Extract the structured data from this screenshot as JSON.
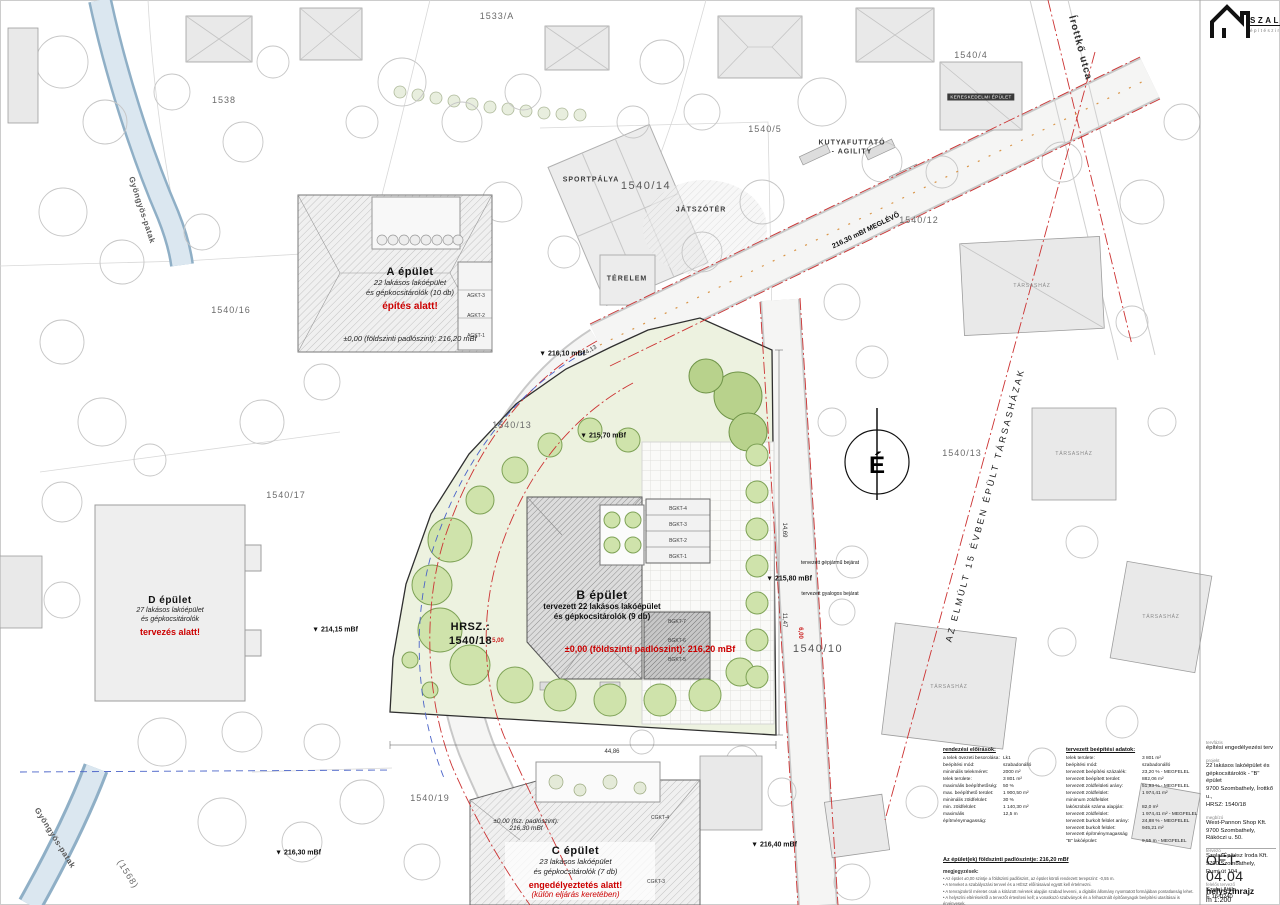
{
  "logo": {
    "name": "SZALAI",
    "subtitle": "építésziroda"
  },
  "site": {
    "hrsz_line1": "HRSZ.:",
    "hrsz_line2": "1540/18"
  },
  "buildings": {
    "a": {
      "title": "A épület",
      "line1": "22 lakásos lakóépület",
      "line2": "és gépkocsitárolók (10 db)",
      "status": "építés alatt!",
      "level": "±0,00 (földszinti padlószint): 216,20 mBf"
    },
    "b": {
      "title": "B épület",
      "line1": "tervezett 22 lakásos lakóépület",
      "line2": "és gépkocsitárolók (9 db)",
      "level": "±0,00 (földszinti padlószint): 216,20 mBf"
    },
    "c": {
      "title": "C épület",
      "line1": "23 lakásos lakóépület",
      "line2": "és gépkocsitárolók (7 db)",
      "status1": "engedélyeztetés alatt!",
      "status2": "(külön eljárás keretében)",
      "level1": "±0,00 (fsz. padlószint):",
      "level2": "216,30 mBf"
    },
    "d": {
      "title": "D épület",
      "line1": "27 lakásos lakóépület",
      "line2": "és gépkocsitárolók",
      "status": "tervezés alatt!"
    }
  },
  "titleblock": {
    "phase_label": "tervfázis",
    "phase": "építési engedélyezési terv",
    "project_label": "projekt",
    "project_lines": [
      "22 lakásos lakóépület és",
      "gépkocsitárolók - \"B\" épület",
      "9700 Szombathely, Írottkő u.,",
      "HRSZ: 1540/18"
    ],
    "client_label": "megbízó",
    "client_lines": [
      "West-Pannon Shop Kft.",
      "9700 Szombathely,",
      "Rákóczi u. 50."
    ],
    "designer_label": "tervező",
    "designer_lines": [
      "Szalai Építész Iroda Kft.",
      "9700 Szombathely,",
      "Rumi út 104."
    ],
    "lead_label": "felelős tervező",
    "lead_lines": [
      "Szalai Attila",
      "É 16-0240"
    ],
    "sheet_no": "OÉT-04.04",
    "sheet_name": "helyszínrajz",
    "scale": "m 1:200",
    "date_label": "dátum",
    "date": "2023. november",
    "jobno_label": "munkaszám",
    "jobno": "2024/09-B-03"
  },
  "reg_table": {
    "title": "rendezési előírások:",
    "rows": [
      [
        "a telek övezeti besorolása:",
        "Lk1"
      ],
      [
        "beépítési mód:",
        "szabadonálló"
      ],
      [
        "minimális telekméret:",
        "2000 m²"
      ],
      [
        "telek területe:",
        "3 801 m²"
      ],
      [
        "maximális beépíthetőség:",
        "50 %"
      ],
      [
        "max. beépíthető terület:",
        "1 900,50 m²"
      ],
      [
        "minimális zöldfelület:",
        "30 %"
      ],
      [
        "min. zöldfelület:",
        "1 140,30 m²"
      ],
      [
        "maximális építménymagasság:",
        "12,5 m"
      ]
    ]
  },
  "plan_table": {
    "title": "tervezett beépítési adatok:",
    "rows": [
      [
        "telek területe:",
        "3 801 m²"
      ],
      [
        "beépítési mód:",
        "szabadonálló"
      ],
      [
        "tervezett beépítési százalék:",
        "23,20 % - MEGFELEL"
      ],
      [
        "tervezett beépített terület:",
        "882,06 m²"
      ],
      [
        "tervezett zöldfelületi arány:",
        "51,93 % - MEGFELEL"
      ],
      [
        "tervezett zöldfelület:",
        "1 974,41 m²"
      ],
      [
        "minimum zöldfelület",
        ""
      ],
      [
        "lakószobák száma alapján:",
        "82,0 m²"
      ],
      [
        "tervezett zöldfelület:",
        "1 974,41 m² - MEGFELEL"
      ],
      [
        "tervezett burkolt felület arány:",
        "24,88 % - MEGFELEL"
      ],
      [
        "tervezett burkolt felület:",
        "945,21 m²"
      ],
      [
        "tervezett építménymagasság",
        ""
      ],
      [
        "\"B\" lakóépület:",
        "9,55 m - MEGFELEL"
      ]
    ]
  },
  "floor_note": "Az épület(ek) földszinti padlószintje: 216,20 mBf",
  "remarks": {
    "title": "megjegyzések:",
    "items": [
      "Az épület ±0,00 szintje a földszinti padlószint, az épület körüli rendezett terepszint: -0,55 m.",
      "A terveket a szabályozási tervvel és a HÉSZ előírásaival együtt kell értelmezni.",
      "A tervrajzokról méretet csak a kótázott méretek alapján szabad levenni, a digitális állomány nyomtatott formájában pontatlanság lehet.",
      "A helyszíni eltérésekről a tervezőt értesíteni kell; a vonatkozó szabványok és a felhasznált építőanyagok beépítési utasításai is érvényesek."
    ]
  },
  "map_labels": [
    {
      "t": "1533/A",
      "x": 497,
      "y": 16,
      "c": "parcel",
      "n": "parcel-label-1533a"
    },
    {
      "t": "1538",
      "x": 224,
      "y": 100,
      "c": "parcel",
      "n": "parcel-label-1538"
    },
    {
      "t": "1540/4",
      "x": 971,
      "y": 55,
      "c": "parcel",
      "n": "parcel-label-1540-4"
    },
    {
      "t": "1540/5",
      "x": 765,
      "y": 129,
      "c": "parcel",
      "n": "parcel-label-1540-5"
    },
    {
      "t": "1540/12",
      "x": 919,
      "y": 220,
      "c": "parcel",
      "n": "parcel-label-1540-12"
    },
    {
      "t": "1540/14",
      "x": 646,
      "y": 186,
      "c": "parcel-lg",
      "n": "parcel-label-1540-14"
    },
    {
      "t": "1540/16",
      "x": 231,
      "y": 310,
      "c": "parcel",
      "n": "parcel-label-1540-16"
    },
    {
      "t": "1540/13",
      "x": 512,
      "y": 425,
      "c": "parcel",
      "n": "parcel-label-1540-13w"
    },
    {
      "t": "1540/17",
      "x": 286,
      "y": 495,
      "c": "parcel",
      "n": "parcel-label-1540-17"
    },
    {
      "t": "1540/13",
      "x": 962,
      "y": 453,
      "c": "parcel",
      "n": "parcel-label-1540-13e"
    },
    {
      "t": "1540/10",
      "x": 818,
      "y": 649,
      "c": "parcel-lg",
      "n": "parcel-label-1540-10"
    },
    {
      "t": "1540/19",
      "x": 430,
      "y": 798,
      "c": "parcel",
      "n": "parcel-label-1540-19"
    },
    {
      "t": "SPORTPÁLYA",
      "x": 591,
      "y": 180,
      "c": "area",
      "n": "sports-field-label"
    },
    {
      "t": "JÁTSZÓTÉR",
      "x": 701,
      "y": 210,
      "c": "area",
      "n": "playground-label"
    },
    {
      "t": "TÉRELEM",
      "x": 627,
      "y": 279,
      "c": "area",
      "n": "terelem-label"
    },
    {
      "t": "KUTYAFUTTATÓ",
      "x": 852,
      "y": 143,
      "c": "area",
      "n": "dog-run-label"
    },
    {
      "t": "- AGILITY",
      "x": 852,
      "y": 152,
      "c": "area",
      "n": "dog-run-label2"
    },
    {
      "t": "Írottkő utca",
      "x": 1080,
      "y": 48,
      "c": "street",
      "r": 75,
      "n": "street-name-irottko"
    },
    {
      "t": "Gyöngyös-patak",
      "x": 142,
      "y": 210,
      "c": "street-sm",
      "r": 72,
      "n": "stream-name-north"
    },
    {
      "t": "Gyöngyös-patak",
      "x": 55,
      "y": 838,
      "c": "street-sm",
      "r": 58,
      "n": "stream-name-south"
    },
    {
      "t": "(1568)",
      "x": 128,
      "y": 874,
      "c": "parcel",
      "r": 58,
      "n": "parcel-label-1568"
    },
    {
      "t": "AZ ELMÚLT 15 ÉVBEN ÉPÜLT TÁRSASHÁZAK",
      "x": 985,
      "y": 505,
      "c": "diag",
      "r": -75,
      "n": "condo-diagonal-note"
    },
    {
      "t": "216,30 mBf MEGLÉVŐ",
      "x": 866,
      "y": 231,
      "c": "elev",
      "r": -26,
      "n": "elevation-existing"
    },
    {
      "t": "▼ 216,10 mBf",
      "x": 562,
      "y": 354,
      "c": "elev",
      "n": "elevation-21610"
    },
    {
      "t": "▼ 215,70 mBf",
      "x": 603,
      "y": 436,
      "c": "elev",
      "n": "elevation-21570"
    },
    {
      "t": "▼ 214,15 mBf",
      "x": 335,
      "y": 630,
      "c": "elev",
      "n": "elevation-21415"
    },
    {
      "t": "▼ 215,80 mBf",
      "x": 789,
      "y": 579,
      "c": "elev",
      "n": "elevation-21580"
    },
    {
      "t": "▼ 216,40 mBf",
      "x": 774,
      "y": 845,
      "c": "elev",
      "n": "elevation-21640"
    },
    {
      "t": "▼ 216,30 mBf",
      "x": 298,
      "y": 853,
      "c": "elev",
      "n": "elevation-21630"
    },
    {
      "t": "tervezett gépjármű bejárat",
      "x": 830,
      "y": 563,
      "c": "micro",
      "n": "vehicle-entry-label"
    },
    {
      "t": "tervezett gyalogos bejárat",
      "x": 830,
      "y": 594,
      "c": "micro",
      "n": "pedestrian-entry-label"
    },
    {
      "t": "AGKT-3",
      "x": 476,
      "y": 296,
      "c": "tiny",
      "n": "garage-label-a3"
    },
    {
      "t": "AGKT-2",
      "x": 476,
      "y": 316,
      "c": "tiny",
      "n": "garage-label-a2"
    },
    {
      "t": "AGKT-1",
      "x": 476,
      "y": 336,
      "c": "tiny",
      "n": "garage-label-a1"
    },
    {
      "t": "BGKT-4",
      "x": 678,
      "y": 509,
      "c": "tiny",
      "n": "garage-label-b4"
    },
    {
      "t": "BGKT-3",
      "x": 678,
      "y": 525,
      "c": "tiny",
      "n": "garage-label-b3"
    },
    {
      "t": "BGKT-2",
      "x": 678,
      "y": 541,
      "c": "tiny",
      "n": "garage-label-b2"
    },
    {
      "t": "BGKT-1",
      "x": 678,
      "y": 557,
      "c": "tiny",
      "n": "garage-label-b1"
    },
    {
      "t": "BGKT-7",
      "x": 677,
      "y": 622,
      "c": "tiny",
      "n": "garage-label-b7"
    },
    {
      "t": "BGKT-6",
      "x": 677,
      "y": 641,
      "c": "tiny",
      "n": "garage-label-b6"
    },
    {
      "t": "BGKT-5",
      "x": 677,
      "y": 660,
      "c": "tiny",
      "n": "garage-label-b5"
    },
    {
      "t": "CGKT-4",
      "x": 660,
      "y": 818,
      "c": "tiny",
      "n": "garage-label-c4"
    },
    {
      "t": "CGKT-3",
      "x": 656,
      "y": 882,
      "c": "tiny",
      "n": "garage-label-c3"
    },
    {
      "t": "TÁRSASHÁZ",
      "x": 1032,
      "y": 286,
      "c": "ghost",
      "n": "condo-label-1"
    },
    {
      "t": "TÁRSASHÁZ",
      "x": 1074,
      "y": 454,
      "c": "ghost",
      "n": "condo-label-2"
    },
    {
      "t": "TÁRSASHÁZ",
      "x": 1161,
      "y": 617,
      "c": "ghost",
      "n": "condo-label-3"
    },
    {
      "t": "TÁRSASHÁZ",
      "x": 949,
      "y": 687,
      "c": "ghost",
      "n": "condo-label-4"
    },
    {
      "t": "KERESKEDELMI ÉPÜLET",
      "x": 981,
      "y": 97,
      "c": "chip",
      "n": "commercial-building-chip"
    },
    {
      "t": "24,13",
      "x": 590,
      "y": 351,
      "c": "dim",
      "r": -30,
      "n": "dimension-2413"
    },
    {
      "t": "44,86",
      "x": 612,
      "y": 752,
      "c": "dim",
      "n": "dimension-4486"
    },
    {
      "t": "14,69",
      "x": 784,
      "y": 530,
      "c": "dim",
      "r": 90,
      "n": "dimension-1469"
    },
    {
      "t": "11,47",
      "x": 784,
      "y": 620,
      "c": "dim",
      "r": 90,
      "n": "dimension-1147"
    },
    {
      "t": "5,00",
      "x": 498,
      "y": 641,
      "c": "dim-red",
      "n": "dimension-500"
    },
    {
      "t": "6,00",
      "x": 800,
      "y": 633,
      "c": "dim-red",
      "r": 90,
      "n": "dimension-600"
    },
    {
      "t": "É",
      "x": 877,
      "y": 466,
      "c": "north",
      "n": "north-letter"
    }
  ]
}
